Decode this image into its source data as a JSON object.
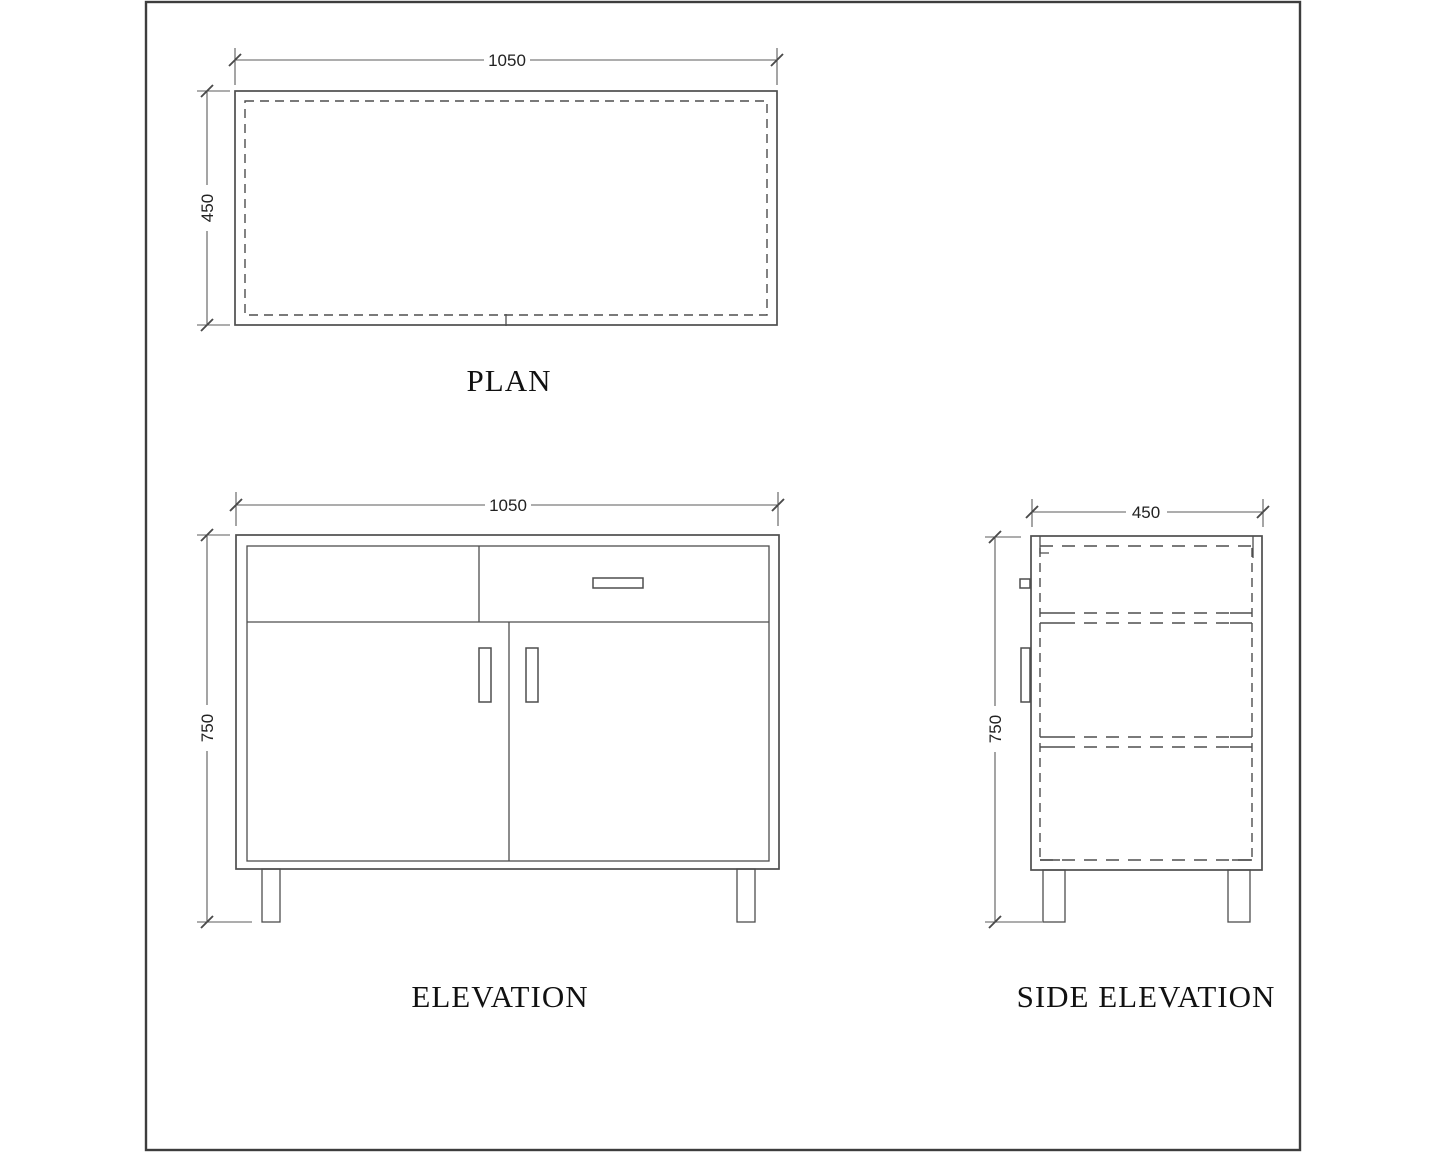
{
  "views": {
    "plan": {
      "label": "PLAN",
      "width_dim": "1050",
      "depth_dim": "450"
    },
    "elevation": {
      "label": "ELEVATION",
      "width_dim": "1050",
      "height_dim": "750"
    },
    "side_elevation": {
      "label": "SIDE ELEVATION",
      "depth_dim": "450",
      "height_dim": "750"
    }
  },
  "components": {
    "plan": [
      "cabinet-top-outline",
      "inner-panel-dashed-outline",
      "center-joint-tick"
    ],
    "elevation": [
      "cabinet-outline",
      "inner-carcass-outline",
      "left-drawer-front",
      "right-drawer-front",
      "drawer-handle",
      "left-door",
      "right-door",
      "left-door-handle",
      "right-door-handle",
      "left-leg",
      "right-leg"
    ],
    "side_elevation": [
      "side-panel-outline",
      "hidden-carcass-dashed",
      "shelf-1-hidden",
      "shelf-2-hidden",
      "drawer-handle-side",
      "door-handle-side",
      "left-leg",
      "right-leg"
    ]
  },
  "colors": {
    "background": "#ffffff",
    "object_line": "#4e4e4e",
    "dimension_line": "#5b5b5b",
    "text": "#111111",
    "frame": "#3d3d3d"
  }
}
